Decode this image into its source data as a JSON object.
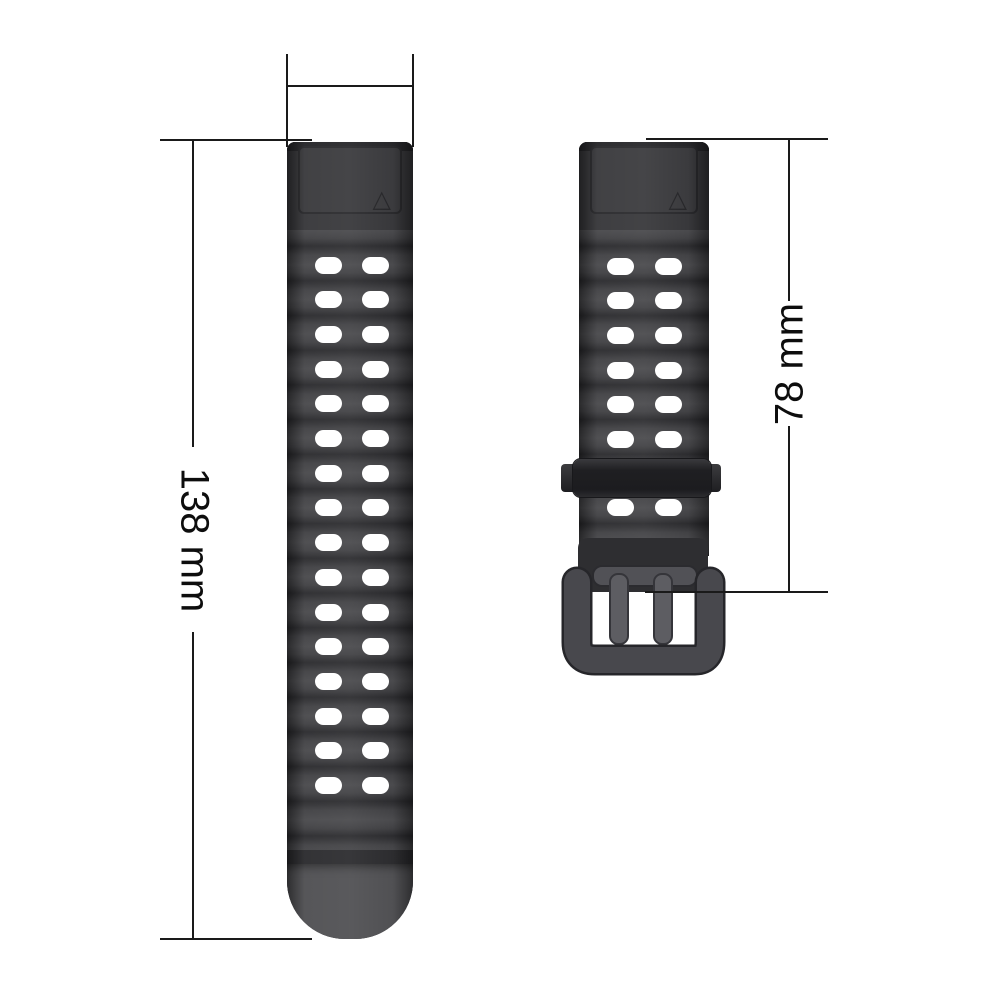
{
  "image": {
    "description_label": "watch band with buckle, dimensioned",
    "background_color": "#ffffff"
  },
  "dimensions": {
    "length_label": "138 mm",
    "buckle_side_label": "78 mm"
  },
  "icons": {
    "triangle_mark": "△"
  },
  "colors": {
    "strap_body": "#3a3a3d",
    "strap_groove": "#28282b",
    "strap_tip": "#4d4d50",
    "lug_section": "#343437",
    "hole": "#ffffff",
    "keeper": "#212124",
    "buckle_frame": "#48484d",
    "buckle_prong": "#5d5d62",
    "dimension_line": "#1a1a1a",
    "label_text": "#0d0d0d"
  },
  "straps": {
    "left": {
      "hole_rows": 16,
      "hole_columns": 2
    },
    "right": {
      "hole_rows_above_keeper": 6,
      "hole_rows_below_keeper": 1,
      "hole_columns": 2
    }
  }
}
